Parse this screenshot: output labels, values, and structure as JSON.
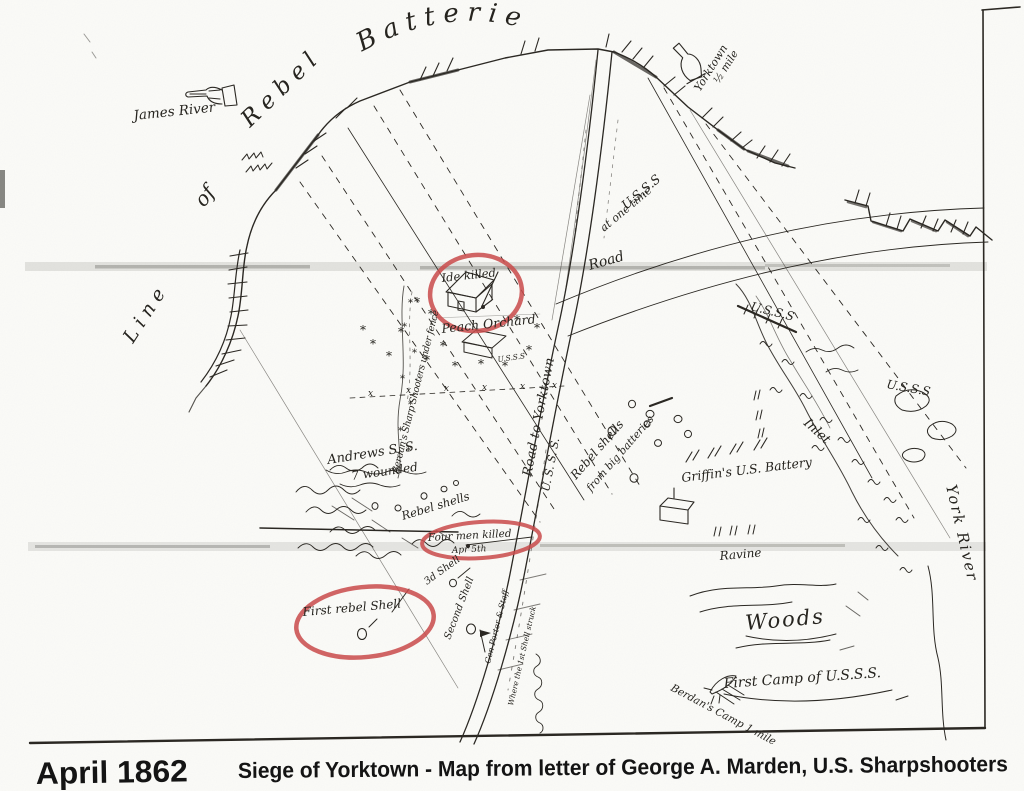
{
  "caption": {
    "date": "April 1862",
    "title": "Siege of Yorktown - Map from letter of George A. Marden, U.S. Sharpshooters"
  },
  "colors": {
    "ink": "#2b2823",
    "red_highlight": "#c94a4a",
    "paper": "#fbfbf8",
    "fold_band": "#a8a8a2"
  },
  "icons": {
    "tree_mark": "*",
    "fence_mark": "x"
  },
  "labels": {
    "batteries": "Batteries",
    "rebel": "Rebel",
    "of": "of",
    "line": "Line",
    "james_river": "James River",
    "yorktown": "Yorktown",
    "half_mile": "½ mile",
    "usss": "U.S.S.S",
    "at_one_time": "at one time",
    "road": "Road",
    "road_to_yorktown": "Road to Yorktown",
    "usss_road": "U. S. S. S.",
    "ide_killed": "Ide killed",
    "peach_orchard": "Peach Orchard",
    "usss_small": "U.S.S.S",
    "berdans_fence": "Berdan's Sharp Shooters under fence",
    "andrews": "Andrews S. S.",
    "wounded": "7 wounded",
    "rebel_shells": "Rebel shells",
    "four_men_killed": "Four men killed",
    "apr_5": "Apr 5th",
    "third_shell": "3d Shell",
    "second_shell": "Second Shell",
    "gen_porter": "Gen Porter & Staff",
    "first_shell_note": "Where the 1st Shell struck",
    "first_rebel_shell": "First rebel Shell",
    "rebel_shells_2": "Rebel shells",
    "from_big_batteries": "from big batteries",
    "griffins_battery": "Griffin's U.S. Battery",
    "usss_marsh_1": "U.S.S.S",
    "usss_marsh_2": "U.S.S.S",
    "inlet": "Inlet",
    "ravine": "Ravine",
    "woods": "Woods",
    "first_camp": "First Camp of U.S.S.S.",
    "berdans_camp": "Berdan's Camp 1 mile",
    "york_river": "York River"
  }
}
